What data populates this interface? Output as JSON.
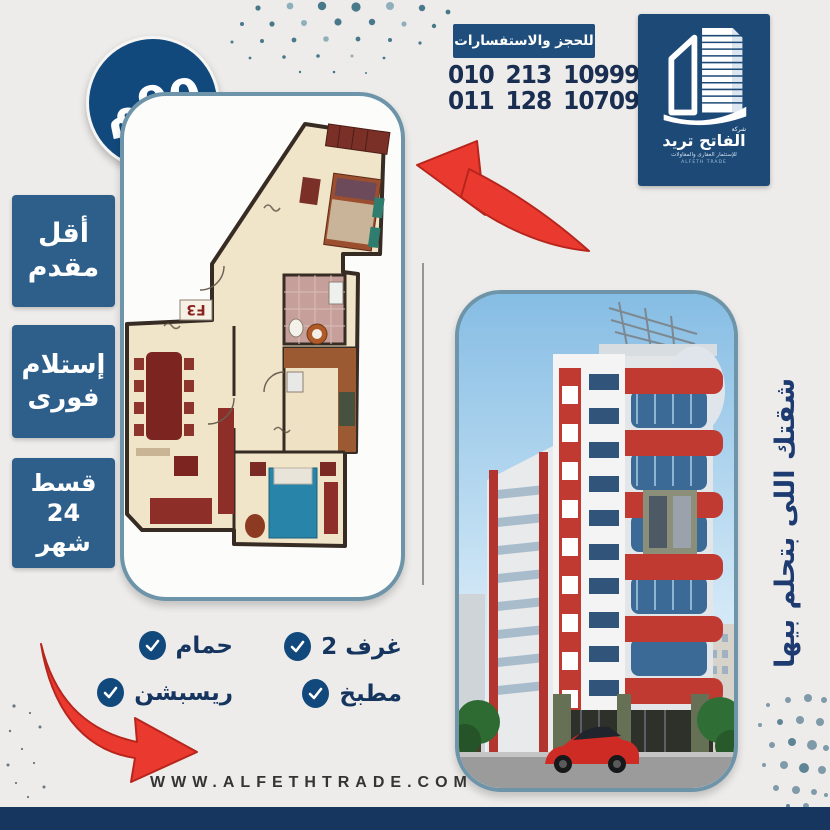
{
  "area_badge": {
    "label": "90م"
  },
  "contact": {
    "banner": "للحجز والاستفسارات",
    "phones": [
      "010 213 10999",
      "011 128 10709"
    ]
  },
  "logo": {
    "company_small": "شركة",
    "name": "الفاتح تريد",
    "tagline": "للإستثمار العقارى والمقاولات",
    "tagline2": "ALFETH TRADE"
  },
  "side_badges": [
    {
      "line1": "أقل",
      "line2": "مقدم"
    },
    {
      "line1": "إستلام",
      "line2": "فورى"
    },
    {
      "line1": "قسط",
      "line2": "24",
      "line3": "شهر"
    }
  ],
  "floor_plan": {
    "unit_label": "F3"
  },
  "vertical_tagline": "شقتك اللى بتحلم بيها",
  "features": {
    "rooms": "2 غرف",
    "kitchen": "مطبخ",
    "bath": "حمام",
    "reception": "ريسبشن"
  },
  "website": "WWW.ALFETHTRADE.COM",
  "colors": {
    "navy": "#16365f",
    "badge_blue": "#2e5f8a",
    "circle_blue": "#11497d",
    "border_blue": "#6d94a9",
    "arrow_red": "#ea3a30"
  }
}
